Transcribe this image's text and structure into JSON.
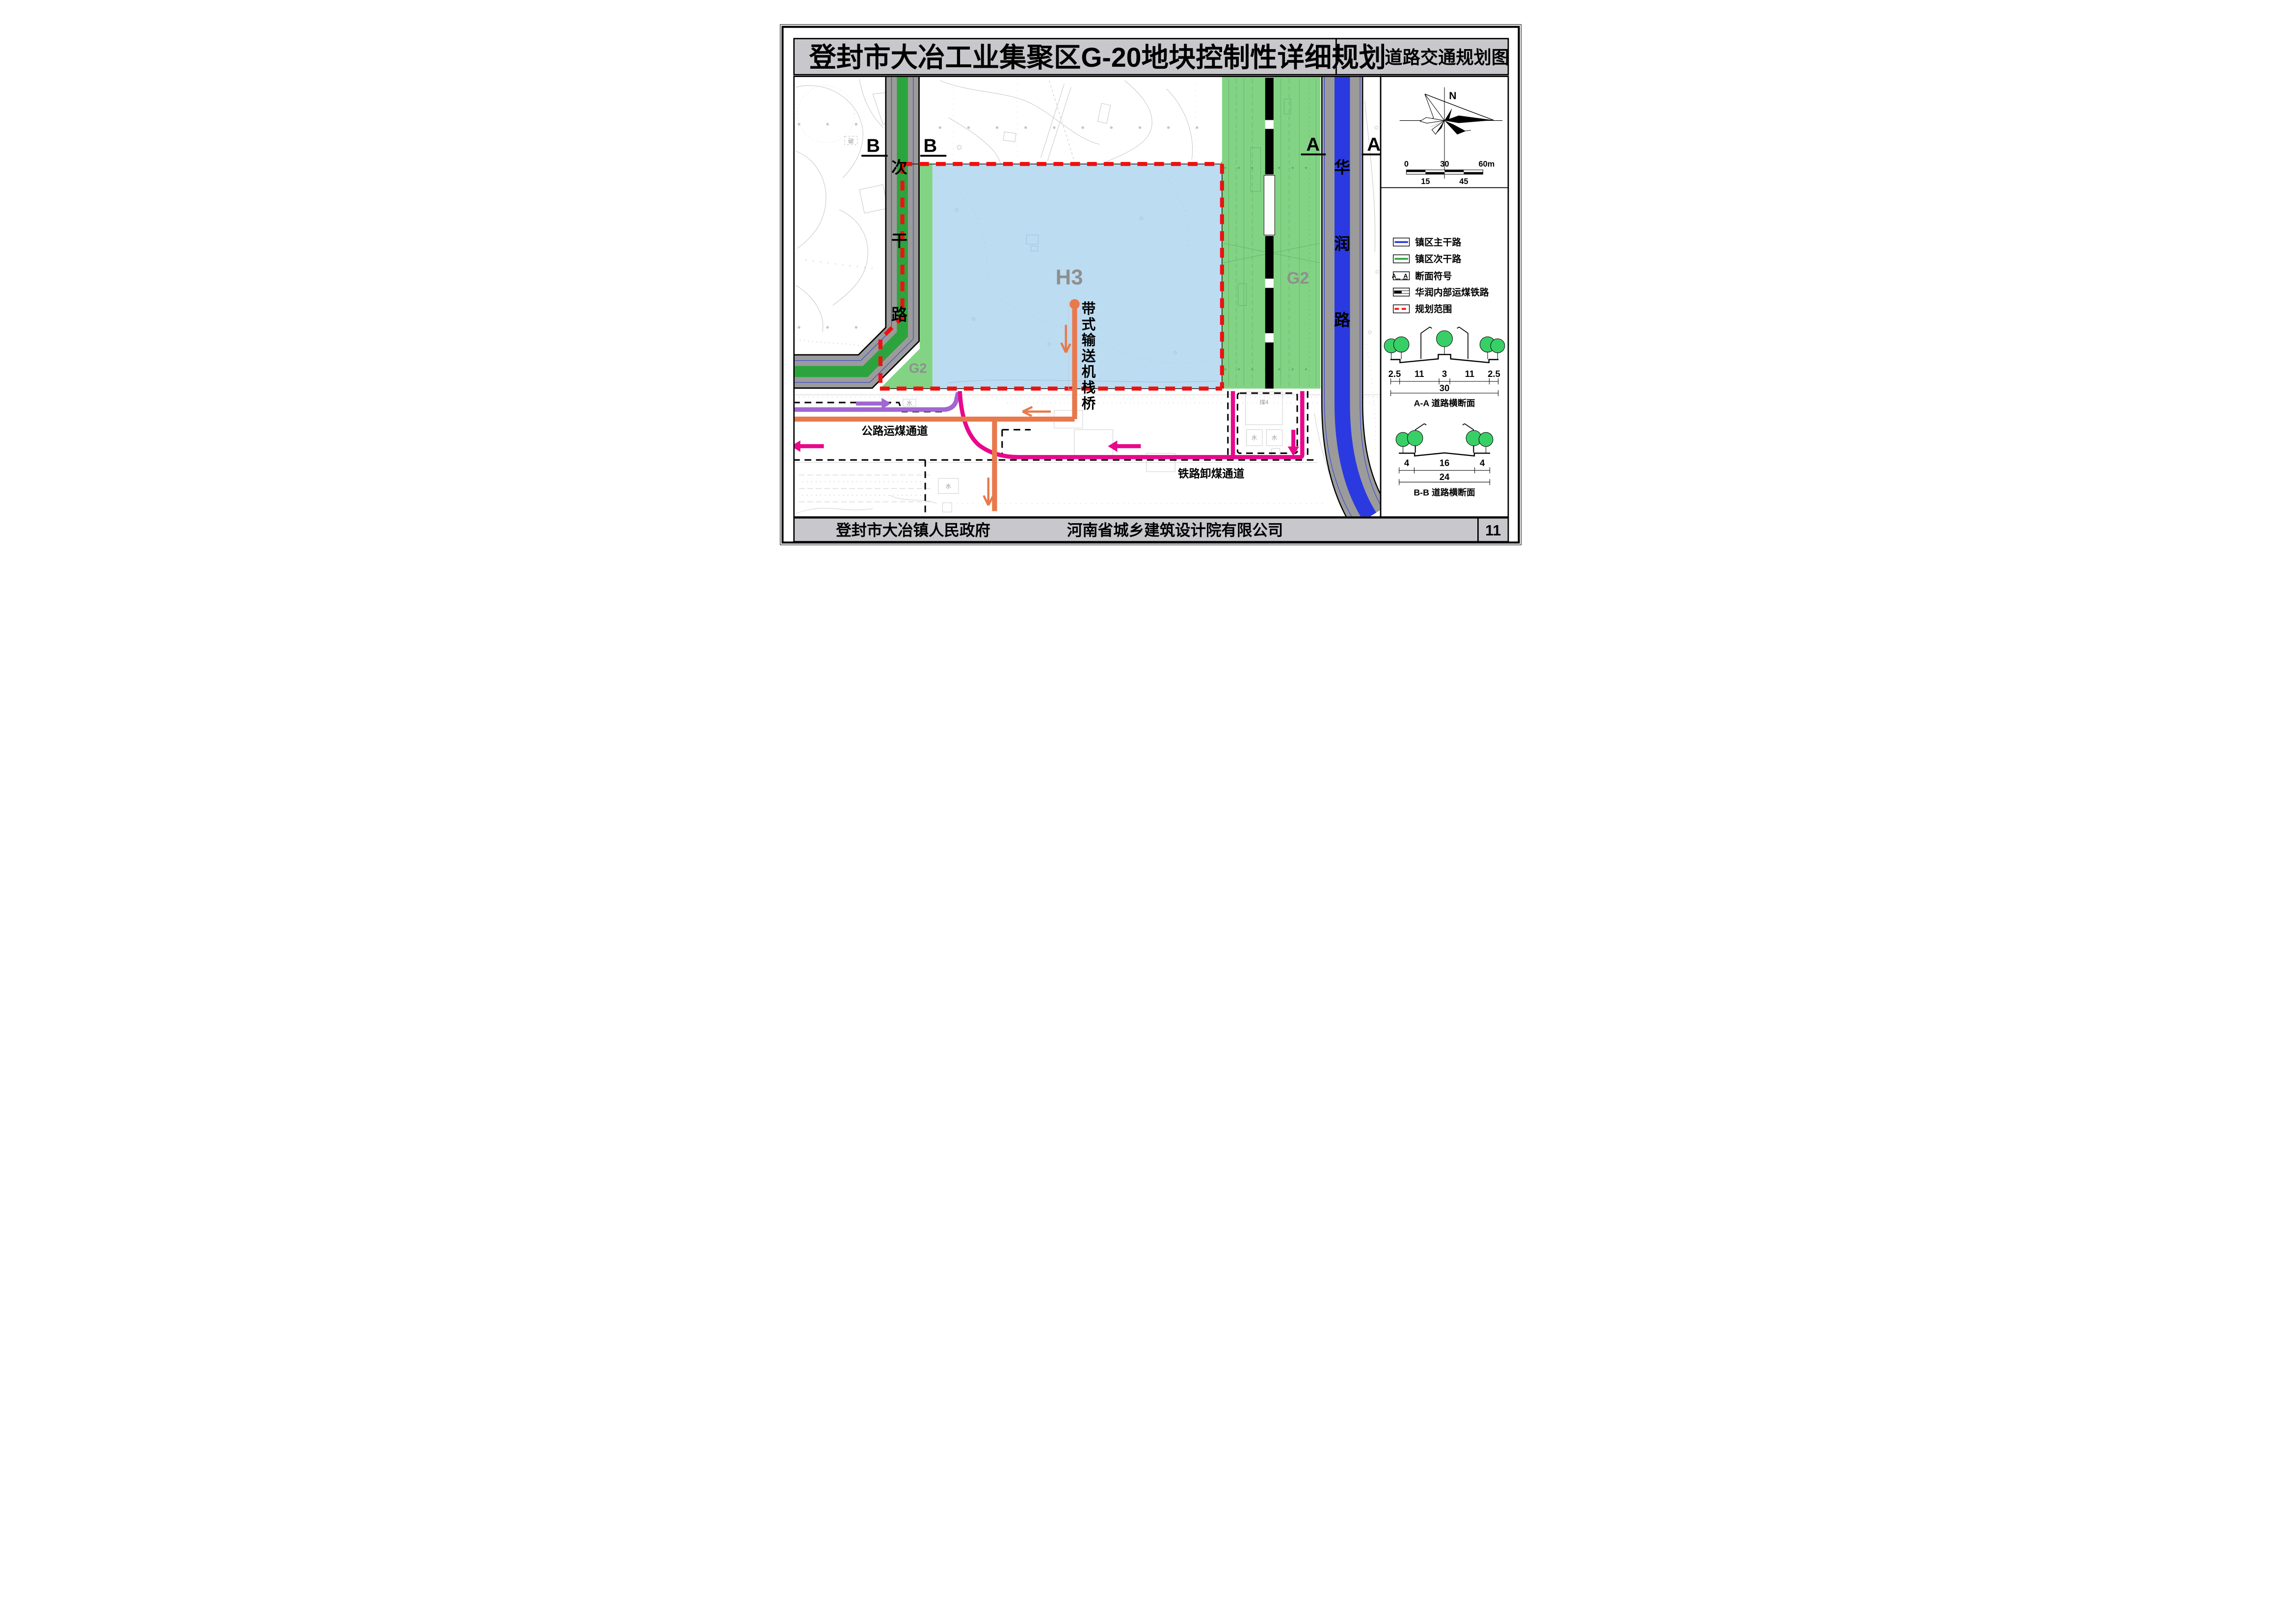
{
  "title": {
    "left": "登封市大冶工业集聚区G-20地块控制性详细规划",
    "right": "道路交通规划图"
  },
  "footer": {
    "left": "登封市大冶镇人民政府",
    "center": "河南省城乡建筑设计院有限公司",
    "page_number": "11"
  },
  "map": {
    "labels": {
      "h3": "H3",
      "g2_right": "G2",
      "g2_left": "G2",
      "b_marker": "B",
      "a_marker": "A",
      "road_left_vertical": [
        "次",
        "干",
        "路"
      ],
      "road_right_vertical": [
        "华",
        "润",
        "路"
      ],
      "conveyor_vertical": [
        "带",
        "式",
        "输",
        "送",
        "机",
        "栈",
        "桥"
      ],
      "road_coal": "公路运煤通道",
      "rail_coal": "铁路卸煤通道"
    },
    "minor": [
      {
        "t": "水"
      },
      {
        "t": "水"
      },
      {
        "t": "水"
      },
      {
        "t": "水"
      },
      {
        "t": "煤4"
      },
      {
        "t": "破"
      }
    ],
    "colors": {
      "secondary_road_green": "#2ca43e",
      "main_road_blue": "#2a3ae0",
      "g2_green": "#82d484",
      "h3_blue": "#bcdcf2",
      "boundary_red": "#ee1111",
      "conveyor_orange": "#e8794d",
      "road_coal_purple": "#a066d2",
      "rail_coal_pink": "#e8088c",
      "road_gray": "#9b9b9b"
    }
  },
  "sidebar": {
    "compass_n": "N",
    "scalebar": {
      "top": [
        "0",
        "30",
        "60m"
      ],
      "bottom": [
        "15",
        "45"
      ]
    },
    "legend": {
      "items": [
        {
          "label": "镇区主干路"
        },
        {
          "label": "镇区次干路"
        },
        {
          "label": "断面符号",
          "symbol_letters": "A A"
        },
        {
          "label": "华润内部运煤铁路"
        },
        {
          "label": "规划范围"
        }
      ]
    },
    "sections": {
      "aa": {
        "dims": [
          "2.5",
          "11",
          "3",
          "11",
          "2.5"
        ],
        "total": "30",
        "caption": "A-A 道路横断面"
      },
      "bb": {
        "dims": [
          "4",
          "16",
          "4"
        ],
        "total": "24",
        "caption": "B-B 道路横断面"
      }
    }
  }
}
